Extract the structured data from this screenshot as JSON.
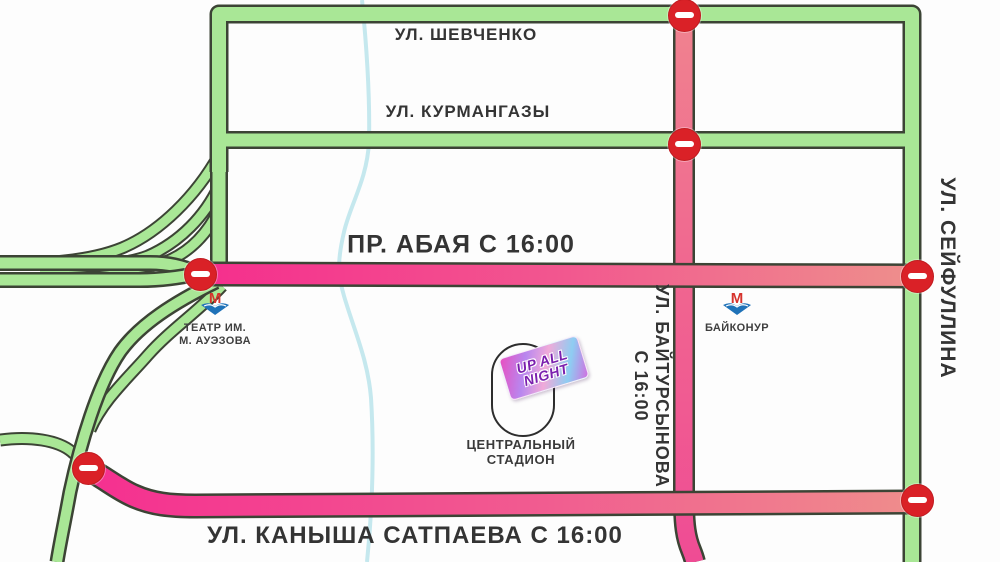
{
  "streets": {
    "shevchenko": "УЛ. ШЕВЧЕНКО",
    "kurmangazy": "УЛ. КУРМАНГАЗЫ",
    "abay": "ПР. АБАЯ С 16:00",
    "satpayeva": "УЛ. КАНЫША САТПАЕВА С 16:00",
    "seifullina": "УЛ. СЕЙФУЛЛИНА",
    "baitursynova": {
      "line1": "УЛ. БАЙТУРСЫНОВА",
      "line2": "С 16:00"
    }
  },
  "metro_stations": {
    "auezov_theater": {
      "line1": "ТЕАТР ИМ.",
      "line2": "М. АУЭЗОВА"
    },
    "baikonur": {
      "label": "БАЙКОНУР"
    }
  },
  "venue": {
    "sticker": {
      "line1": "UP ALL",
      "line2": "NIGHT"
    },
    "stadium": {
      "line1": "ЦЕНТРАЛЬНЫЙ",
      "line2": "СТАДИОН"
    }
  },
  "icons": {
    "no_entry": "no-entry-sign",
    "metro": "almaty-metro-logo",
    "river": "river-line"
  },
  "colors": {
    "open_road_green": "#a9e796",
    "closed_road_pink": "#f53090",
    "closed_road_salmon": "#ef8d8c",
    "no_entry_red": "#da2127",
    "river_blue": "#c5e8ee",
    "road_casing": "#3c4435",
    "metro_red": "#d6332d",
    "metro_blue": "#1f72b8",
    "label_text": "#343434"
  }
}
